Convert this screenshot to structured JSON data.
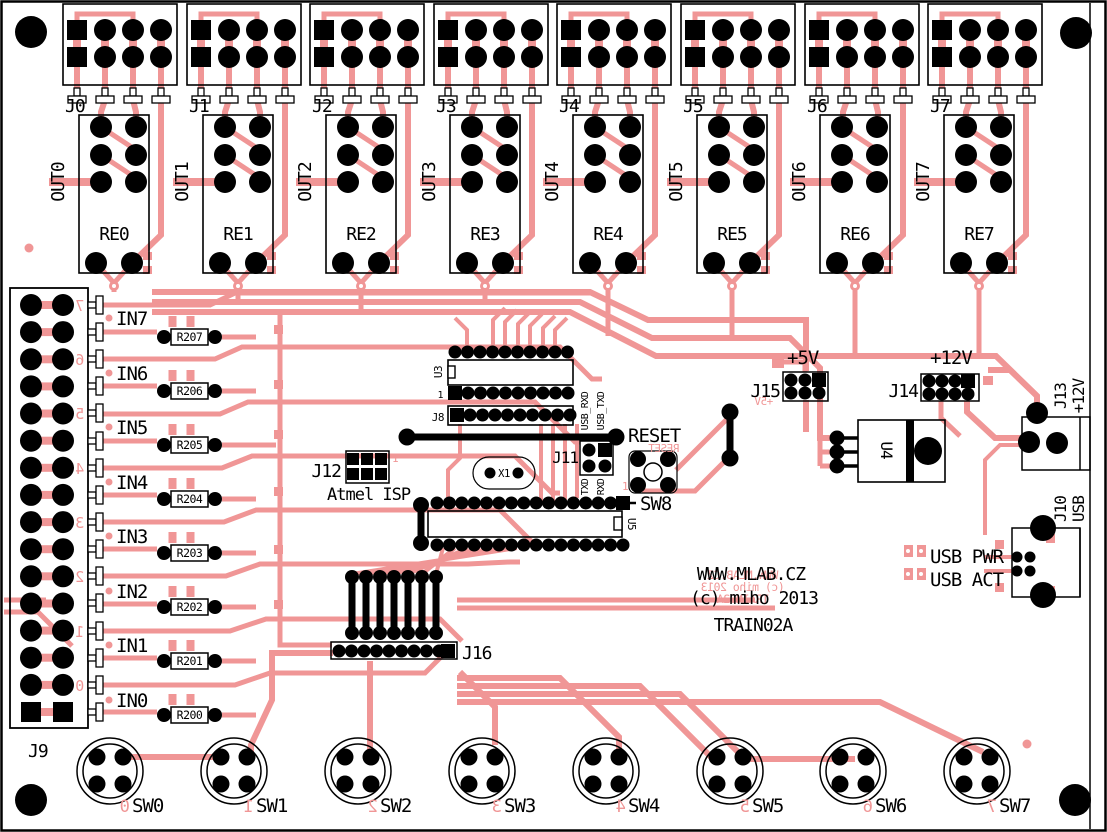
{
  "board": {
    "site": "WWW.MLAB.CZ",
    "copyright": "(c) miho 2013",
    "title": "TRAIN02A"
  },
  "mirror": {
    "site": "WWW.MLAB.CZ",
    "copyright": "(c) miho 2013",
    "title": "TRAIN02A"
  },
  "colors": {
    "trace": "#F09696",
    "silkscreen": "#000000",
    "board": "#FFFFFF"
  },
  "connectors": [
    "J0",
    "J1",
    "J2",
    "J3",
    "J4",
    "J5",
    "J6",
    "J7"
  ],
  "outputs": [
    "OUT0",
    "OUT1",
    "OUT2",
    "OUT3",
    "OUT4",
    "OUT5",
    "OUT6",
    "OUT7"
  ],
  "relays": [
    "RE0",
    "RE1",
    "RE2",
    "RE3",
    "RE4",
    "RE5",
    "RE6",
    "RE7"
  ],
  "inputs": [
    "IN7",
    "IN6",
    "IN5",
    "IN4",
    "IN3",
    "IN2",
    "IN1",
    "IN0"
  ],
  "resistors": [
    "R207",
    "R206",
    "R205",
    "R204",
    "R203",
    "R202",
    "R201",
    "R200"
  ],
  "left_connector": {
    "label": "J9",
    "pin_numbers": [
      "7",
      "6",
      "5",
      "4",
      "3",
      "2",
      "1",
      "0"
    ]
  },
  "switches": {
    "labels": [
      "SW0",
      "SW1",
      "SW2",
      "SW3",
      "SW4",
      "SW5",
      "SW6",
      "SW7"
    ],
    "pin_numbers": [
      "0",
      "1",
      "2",
      "3",
      "4",
      "5",
      "6",
      "7"
    ]
  },
  "center": {
    "u3": "U3",
    "pin1": "1",
    "j8": "J8",
    "j11": "J11",
    "usb_rxd": "USB_RXD",
    "usb_txd": "USB_TXD",
    "txd": "TXD",
    "rxd": "RXD",
    "x1": "X1",
    "j12": "J12",
    "j12_pin1": "1",
    "atmel_isp": "Atmel ISP",
    "reset": "RESET",
    "reset_mirror": "RESET",
    "sw8": "SW8",
    "sw8_pin1": "1",
    "u5": "U5",
    "j16": "J16"
  },
  "power": {
    "plus5v": "+5V",
    "plus5v_mirror": "+5V",
    "j15": "J15",
    "plus12v": "+12V",
    "j14": "J14",
    "u4": "U4",
    "j13": "J13",
    "j13_voltage": "+12V",
    "j10": "J10",
    "j10_type": "USB",
    "usb_pwr": "USB PWR",
    "usb_act": "USB ACT"
  }
}
